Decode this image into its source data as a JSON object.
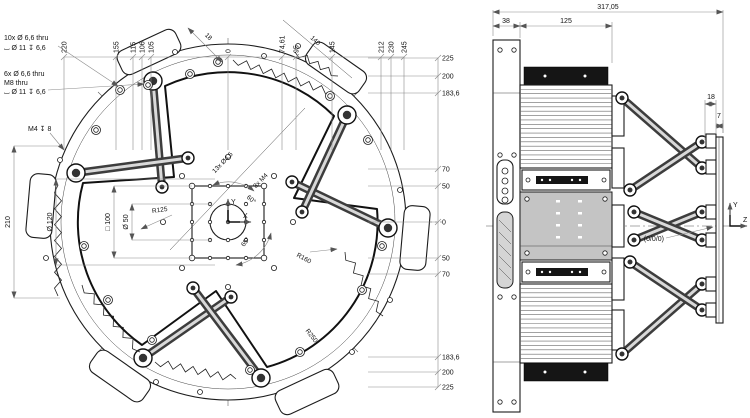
{
  "left_view": {
    "callout_10x": {
      "line1": "10x  Ø 6,6 thru",
      "line2": "⌴ Ø 11  ↧ 6,6"
    },
    "callout_6x": {
      "line1": "6x  Ø 6,6 thru",
      "line2": "M8 thru",
      "line3": "⌴ Ø 11  ↧ 6,6"
    },
    "callout_m4": "M4 ↧ 8",
    "top_ordinates": [
      "220",
      "155",
      "115",
      "106",
      "105",
      "0",
      "74,61",
      "95",
      "145",
      "212",
      "230",
      "245"
    ],
    "right_ordinates": [
      "225",
      "200",
      "183,6",
      "70",
      "50",
      "0",
      "50",
      "70",
      "183,6",
      "200",
      "225"
    ],
    "left_dims": {
      "overall": "210",
      "d120": "Ø 120",
      "sq100": "□ 100",
      "d50": "Ø 50"
    },
    "inner_labels": {
      "holes13": "13x Ø4,5",
      "holes8": "8x M4",
      "angle_top": "60°",
      "angle_bottom": "65°",
      "r125": "R125",
      "r160": "R160",
      "r250": "R250",
      "diag18": "18",
      "diag140": "140",
      "axis_x": "X",
      "axis_y": "Y"
    }
  },
  "right_view": {
    "dims": {
      "overall": "317,05",
      "flange": "38",
      "body": "125",
      "offset18": "18",
      "plate7": "7"
    },
    "origin_label": "(0/0/0)",
    "axes": {
      "y": "Y",
      "z": "Z"
    }
  },
  "colors": {
    "line": "#1c1c1c",
    "dim": "#8a8a8a",
    "body_gray": "#c4c4c4",
    "cap_black": "#151515"
  }
}
